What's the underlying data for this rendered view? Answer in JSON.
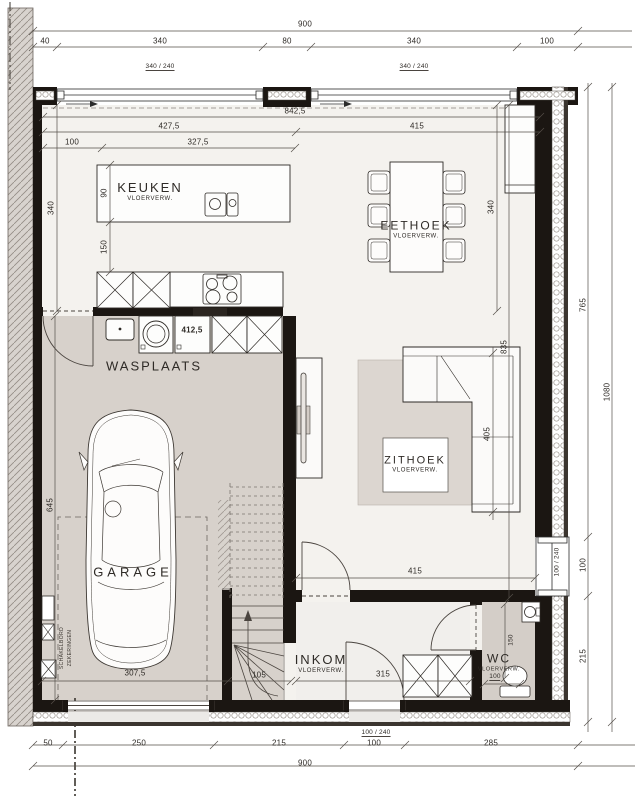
{
  "plan": {
    "rooms": {
      "keuken": {
        "name": "KEUKEN",
        "sub": "VLOERVERW."
      },
      "eethoek": {
        "name": "EETHOEK",
        "sub": "VLOERVERW."
      },
      "zithoek": {
        "name": "ZITHOEK",
        "sub": "VLOERVERW."
      },
      "wasplaats": {
        "name": "WASPLAATS"
      },
      "garage": {
        "name": "GARAGE"
      },
      "inkom": {
        "name": "INKOM",
        "sub": "VLOERVERW."
      },
      "wc": {
        "name": "WC",
        "sub": "VLOERVERW."
      }
    },
    "annotations": {
      "window_top_left": "340 / 240",
      "window_top_right": "340 / 240",
      "window_right": "100 / 240",
      "door_front": "100 / 240",
      "electrical_line1": "SCHAKELBORD",
      "electrical_line2": "ZEKERINGEN"
    },
    "dims": {
      "top_total": "900",
      "top_40": "40",
      "top_340a": "340",
      "top_80": "80",
      "top_340b": "340",
      "top_100": "100",
      "inner_8425": "842,5",
      "inner_4275": "427,5",
      "inner_415": "415",
      "inner_100": "100",
      "inner_3275": "327,5",
      "island_90": "90",
      "gap_150": "150",
      "left_340": "340",
      "dining_340": "340",
      "living_835": "835",
      "sofa_405": "405",
      "washer_4125": "412,5",
      "garage_645": "645",
      "garage_3075": "307,5",
      "stair_105": "105",
      "living_415": "415",
      "inkom_315": "315",
      "wc_150": "150",
      "wc_100": "100",
      "right_765": "765",
      "right_100": "100",
      "right_215": "215",
      "right_1080": "1080",
      "bottom_50": "50",
      "bottom_250": "250",
      "bottom_215": "215",
      "bottom_100": "100",
      "bottom_285": "285",
      "bottom_total": "900"
    },
    "colors": {
      "wall": "#1b1612",
      "floor_warm": "#d7d1cb",
      "floor_light": "#f4f2ee",
      "rug": "#dcd6d0",
      "hatch_wall": "#d8d3ce",
      "line": "#4a443f"
    }
  }
}
